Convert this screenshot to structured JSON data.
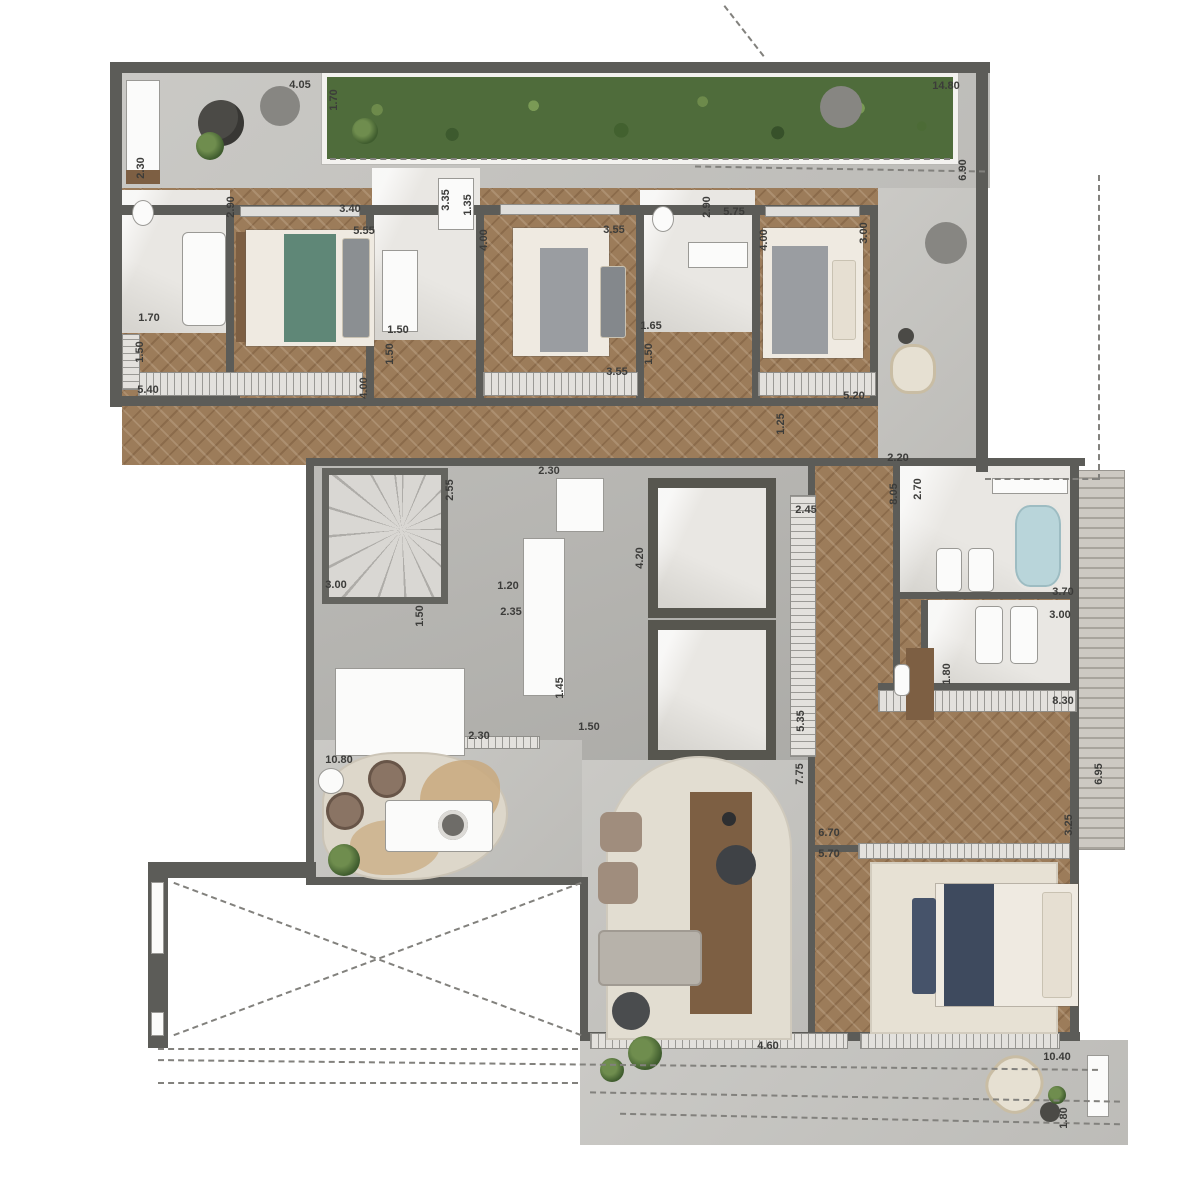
{
  "plan": {
    "title": "penthouse-floor-plan",
    "colors": {
      "wall": "#5c5c58",
      "terrace": "#c7c6c2",
      "hall": "#b6b5b1",
      "wood": "#9c7c5a",
      "marble": "#e9e7e3",
      "garden": "#4f6c3b",
      "rug": "#e2ddd1",
      "tub": "#b9d5da",
      "accent_bed_teal": "#5f8777",
      "accent_bed_navy": "#3e4a5e"
    },
    "dimension_labels": [
      {
        "text": "4.05",
        "x": 300,
        "y": 85,
        "v": false
      },
      {
        "text": "1.70",
        "x": 334,
        "y": 100,
        "v": true
      },
      {
        "text": "14.80",
        "x": 946,
        "y": 86,
        "v": false
      },
      {
        "text": "6.90",
        "x": 963,
        "y": 170,
        "v": true
      },
      {
        "text": "2.30",
        "x": 141,
        "y": 168,
        "v": true
      },
      {
        "text": "2.90",
        "x": 231,
        "y": 207,
        "v": true
      },
      {
        "text": "3.40",
        "x": 350,
        "y": 209,
        "v": false
      },
      {
        "text": "5.55",
        "x": 364,
        "y": 231,
        "v": false
      },
      {
        "text": "3.35",
        "x": 446,
        "y": 200,
        "v": true
      },
      {
        "text": "1.35",
        "x": 468,
        "y": 205,
        "v": true
      },
      {
        "text": "4.00",
        "x": 484,
        "y": 240,
        "v": true
      },
      {
        "text": "3.55",
        "x": 614,
        "y": 230,
        "v": false
      },
      {
        "text": "2.90",
        "x": 707,
        "y": 207,
        "v": true
      },
      {
        "text": "5.75",
        "x": 734,
        "y": 212,
        "v": false
      },
      {
        "text": "4.00",
        "x": 764,
        "y": 240,
        "v": true
      },
      {
        "text": "3.00",
        "x": 864,
        "y": 233,
        "v": true
      },
      {
        "text": "1.70",
        "x": 149,
        "y": 318,
        "v": false
      },
      {
        "text": "1.50",
        "x": 140,
        "y": 352,
        "v": true
      },
      {
        "text": "5.40",
        "x": 148,
        "y": 390,
        "v": false
      },
      {
        "text": "1.50",
        "x": 398,
        "y": 330,
        "v": false
      },
      {
        "text": "1.50",
        "x": 390,
        "y": 354,
        "v": true
      },
      {
        "text": "4.00",
        "x": 364,
        "y": 388,
        "v": true
      },
      {
        "text": "1.65",
        "x": 651,
        "y": 326,
        "v": false
      },
      {
        "text": "1.50",
        "x": 649,
        "y": 354,
        "v": true
      },
      {
        "text": "3.55",
        "x": 617,
        "y": 372,
        "v": false
      },
      {
        "text": "5.20",
        "x": 854,
        "y": 396,
        "v": false
      },
      {
        "text": "1.25",
        "x": 781,
        "y": 424,
        "v": true
      },
      {
        "text": "2.20",
        "x": 898,
        "y": 458,
        "v": false
      },
      {
        "text": "2.30",
        "x": 549,
        "y": 471,
        "v": false
      },
      {
        "text": "2.55",
        "x": 450,
        "y": 490,
        "v": true
      },
      {
        "text": "8.05",
        "x": 894,
        "y": 494,
        "v": true
      },
      {
        "text": "2.70",
        "x": 918,
        "y": 489,
        "v": true
      },
      {
        "text": "2.45",
        "x": 806,
        "y": 510,
        "v": false
      },
      {
        "text": "4.20",
        "x": 640,
        "y": 558,
        "v": true
      },
      {
        "text": "3.00",
        "x": 336,
        "y": 585,
        "v": false
      },
      {
        "text": "1.20",
        "x": 508,
        "y": 586,
        "v": false
      },
      {
        "text": "2.35",
        "x": 511,
        "y": 612,
        "v": false
      },
      {
        "text": "1.50",
        "x": 420,
        "y": 616,
        "v": true
      },
      {
        "text": "3.70",
        "x": 1063,
        "y": 592,
        "v": false
      },
      {
        "text": "3.00",
        "x": 1060,
        "y": 615,
        "v": false
      },
      {
        "text": "1.45",
        "x": 560,
        "y": 688,
        "v": true
      },
      {
        "text": "1.80",
        "x": 947,
        "y": 674,
        "v": true
      },
      {
        "text": "8.30",
        "x": 1063,
        "y": 701,
        "v": false
      },
      {
        "text": "1.50",
        "x": 589,
        "y": 727,
        "v": false
      },
      {
        "text": "2.30",
        "x": 479,
        "y": 736,
        "v": false
      },
      {
        "text": "5.35",
        "x": 801,
        "y": 721,
        "v": true
      },
      {
        "text": "10.80",
        "x": 339,
        "y": 760,
        "v": false
      },
      {
        "text": "6.95",
        "x": 1099,
        "y": 774,
        "v": true
      },
      {
        "text": "7.75",
        "x": 800,
        "y": 774,
        "v": true
      },
      {
        "text": "3.25",
        "x": 1069,
        "y": 825,
        "v": true
      },
      {
        "text": "6.70",
        "x": 829,
        "y": 833,
        "v": false
      },
      {
        "text": "5.70",
        "x": 829,
        "y": 854,
        "v": false
      },
      {
        "text": "4.60",
        "x": 768,
        "y": 1046,
        "v": false
      },
      {
        "text": "10.40",
        "x": 1057,
        "y": 1057,
        "v": false
      },
      {
        "text": "1.80",
        "x": 1064,
        "y": 1118,
        "v": true
      }
    ]
  }
}
